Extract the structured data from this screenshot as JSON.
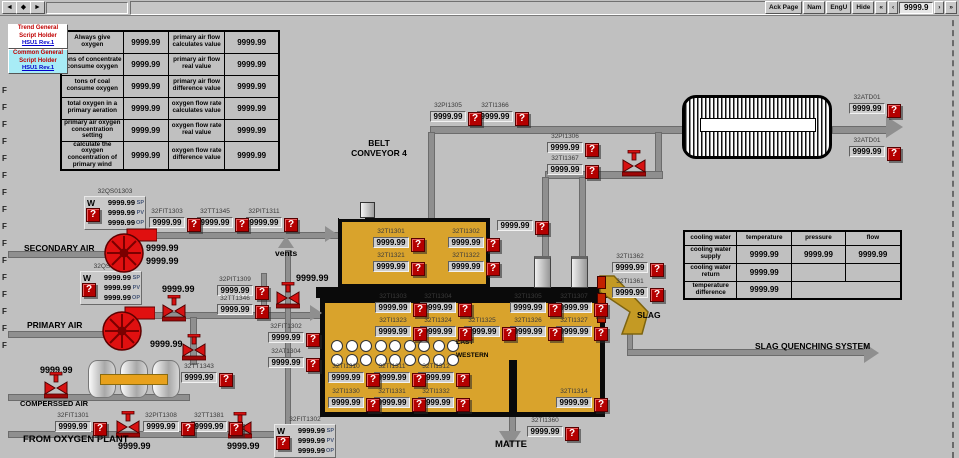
{
  "window": {
    "title": "PRIMARY OXYGEN-ENRICHED AIR OF FURNACE",
    "nav_buttons": [
      "◄",
      "◆",
      "►"
    ],
    "right_buttons": [
      "Ack Page",
      "Nam",
      "EngU",
      "Hide",
      "«",
      "‹"
    ],
    "right_buttons2": [
      "›",
      "»"
    ],
    "page_number": "9999.9"
  },
  "alarm_glyph": "?",
  "script_holders": [
    {
      "line1": "Trend General",
      "line2": "Script Holder",
      "version": "HSU1 Rev.1",
      "bg": "#ffffff"
    },
    {
      "line1": "Common General",
      "line2": "Script Holder",
      "version": "HSU1 Rev.1",
      "bg": "#a8ecf6"
    }
  ],
  "left_table": {
    "rows": [
      [
        "Always give oxygen",
        "9999.99",
        "primary air flow calculates value",
        "9999.99"
      ],
      [
        "tons of concentrate consume oxygen",
        "9999.99",
        "primary air flow real value",
        "9999.99"
      ],
      [
        "tons of coal consume oxygen",
        "9999.99",
        "primary air flow difference value",
        "9999.99"
      ],
      [
        "total oxygen in a primary aeration",
        "9999.99",
        "oxygen flow rate calculates value",
        "9999.99"
      ],
      [
        "primary air oxygen concentration setting",
        "9999.99",
        "oxygen flow rate real value",
        "9999.99"
      ],
      [
        "calculate the oxygen concentration of primary wind",
        "9999.99",
        "oxygen flow rate difference value",
        "9999.99"
      ]
    ]
  },
  "cooling_table": {
    "headers": [
      "cooling water",
      "temperature",
      "pressure",
      "flow"
    ],
    "rows": [
      [
        "cooling water supply",
        "9999.99",
        "9999.99",
        "9999.99"
      ],
      [
        "cooling water return",
        "9999.99",
        "",
        ""
      ],
      [
        "temperature difference",
        "9999.99",
        null,
        null
      ]
    ]
  },
  "equipment": {
    "waste_heat_boiler": "WASTE HEAT BOILER",
    "pressure_vessel": "PRESSURE VESSEL"
  },
  "furnace": {
    "tuyere_rows": 2,
    "tuyeres_per_row": 9
  },
  "labels": [
    {
      "text": "SECONDARY AIR",
      "x": 24,
      "y": 243,
      "fs": 8.5
    },
    {
      "text": "PRIMARY AIR",
      "x": 27,
      "y": 320,
      "fs": 8.5
    },
    {
      "text": "COMPERSSED AIR",
      "x": 20,
      "y": 399,
      "fs": 7.5
    },
    {
      "text": "FROM OXYGEN PLANT",
      "x": 23,
      "y": 434,
      "fs": 9.5
    },
    {
      "text": "vents",
      "x": 275,
      "y": 248,
      "fs": 8.5
    },
    {
      "text": "BELT\nCONVEYOR 4",
      "x": 336,
      "y": 138,
      "fs": 8.5,
      "w": 86
    },
    {
      "text": "MATTE",
      "x": 495,
      "y": 439,
      "fs": 9.5
    },
    {
      "text": "SLAG",
      "x": 637,
      "y": 310,
      "fs": 8.5
    },
    {
      "text": "SLAG QUENCHING SYSTEM",
      "x": 755,
      "y": 341,
      "fs": 8.5
    },
    {
      "text": "EAST",
      "x": 456,
      "y": 339,
      "fs": 6.5
    },
    {
      "text": "WESTERN",
      "x": 456,
      "y": 352,
      "fs": 6.5
    }
  ],
  "readouts": [
    {
      "tag": "32PI1305",
      "value": "9999.99",
      "x": 430,
      "y": 111
    },
    {
      "tag": "32TI1366",
      "value": "9999.99",
      "x": 477,
      "y": 111
    },
    {
      "tag": "32PI1306",
      "value": "9999.99",
      "x": 547,
      "y": 142
    },
    {
      "tag": "32TI1367",
      "value": "9999.99",
      "x": 547,
      "y": 164
    },
    {
      "tag": "32ATD01",
      "value": "9999.99",
      "x": 849,
      "y": 103
    },
    {
      "tag": "32ATD01",
      "value": "9999.99",
      "x": 849,
      "y": 146
    },
    {
      "tag": "32FIT1303",
      "value": "9999.99",
      "x": 149,
      "y": 217
    },
    {
      "tag": "32TT1345",
      "value": "9999.99",
      "x": 197,
      "y": 217
    },
    {
      "tag": "32PIT1311",
      "value": "9999.99",
      "x": 246,
      "y": 217
    },
    {
      "tag": "32PIT1309",
      "value": "9999.99",
      "x": 217,
      "y": 285
    },
    {
      "tag": "32TT1346",
      "value": "9999.99",
      "x": 217,
      "y": 304
    },
    {
      "tag": "32FIT1302",
      "value": "9999.99",
      "x": 268,
      "y": 332
    },
    {
      "tag": "32AT1304",
      "value": "9999.99",
      "x": 268,
      "y": 357
    },
    {
      "tag": "32FIT1301",
      "value": "9999.99",
      "x": 55,
      "y": 421
    },
    {
      "tag": "32PIT1308",
      "value": "9999.99",
      "x": 143,
      "y": 421
    },
    {
      "tag": "32TT1381",
      "value": "9999.99",
      "x": 191,
      "y": 421
    },
    {
      "tag": "32TT1343",
      "value": "9999.99",
      "x": 181,
      "y": 372
    },
    {
      "tag": "32TI1301",
      "value": "9999.99",
      "x": 373,
      "y": 237
    },
    {
      "tag": "32TI1302",
      "value": "9999.99",
      "x": 448,
      "y": 237
    },
    {
      "tag": "32TI1321",
      "value": "9999.99",
      "x": 373,
      "y": 261
    },
    {
      "tag": "32TI1322",
      "value": "9999.99",
      "x": 448,
      "y": 261
    },
    {
      "tag": "32TI1303",
      "value": "9999.99",
      "x": 375,
      "y": 302
    },
    {
      "tag": "32TI1304",
      "value": "9999.99",
      "x": 420,
      "y": 302
    },
    {
      "tag": "32TI1305",
      "value": "9999.99",
      "x": 510,
      "y": 302
    },
    {
      "tag": "32TI1307",
      "value": "9999.99",
      "x": 556,
      "y": 302
    },
    {
      "tag": "32TI1323",
      "value": "9999.99",
      "x": 375,
      "y": 326
    },
    {
      "tag": "32TI1324",
      "value": "9999.99",
      "x": 420,
      "y": 326
    },
    {
      "tag": "32TI1325",
      "value": "9999.99",
      "x": 464,
      "y": 326
    },
    {
      "tag": "32TI1326",
      "value": "9999.99",
      "x": 510,
      "y": 326
    },
    {
      "tag": "32TI1327",
      "value": "9999.99",
      "x": 556,
      "y": 326
    },
    {
      "tag": "32TI1310",
      "value": "9999.99",
      "x": 328,
      "y": 372
    },
    {
      "tag": "32TI1311",
      "value": "9999.99",
      "x": 374,
      "y": 372
    },
    {
      "tag": "32TI1312",
      "value": "9999.99",
      "x": 418,
      "y": 372
    },
    {
      "tag": "32TI1330",
      "value": "9999.99",
      "x": 328,
      "y": 397
    },
    {
      "tag": "32TI1331",
      "value": "9999.99",
      "x": 374,
      "y": 397
    },
    {
      "tag": "32TI1332",
      "value": "9999.99",
      "x": 418,
      "y": 397
    },
    {
      "tag": "32TI1314",
      "value": "9999.99",
      "x": 556,
      "y": 397
    },
    {
      "tag": "32TI1360",
      "value": "9999.99",
      "x": 527,
      "y": 426
    },
    {
      "tag": "32TI1362",
      "value": "9999.99",
      "x": 612,
      "y": 262
    },
    {
      "tag": "32TI1361",
      "value": "9999.99",
      "x": 612,
      "y": 287
    },
    {
      "tag": "",
      "value": "9999.99",
      "x": 497,
      "y": 220
    }
  ],
  "plain_values": [
    {
      "value": "9999.99",
      "x": 146,
      "y": 243
    },
    {
      "value": "9999.99",
      "x": 146,
      "y": 256
    },
    {
      "value": "9999.99",
      "x": 162,
      "y": 284
    },
    {
      "value": "9999.99",
      "x": 296,
      "y": 273
    },
    {
      "value": "9999.99",
      "x": 150,
      "y": 339
    },
    {
      "value": "9999.99",
      "x": 40,
      "y": 365
    },
    {
      "value": "9999.99",
      "x": 118,
      "y": 441
    },
    {
      "value": "9999.99",
      "x": 227,
      "y": 441
    }
  ],
  "faceplates": [
    {
      "tag": "32QS01303",
      "w": "W",
      "rows": [
        [
          "9999.99",
          "SP"
        ],
        [
          "9999.99",
          "PV"
        ],
        [
          "9999.99",
          "OP"
        ]
      ],
      "x": 84,
      "y": 196
    },
    {
      "tag": "32QS01302",
      "w": "W",
      "rows": [
        [
          "9999.99",
          "SP"
        ],
        [
          "9999.99",
          "PV"
        ],
        [
          "9999.99",
          "OP"
        ]
      ],
      "x": 80,
      "y": 271
    },
    {
      "tag": "32FIT1302",
      "w": "W",
      "rows": [
        [
          "9999.99",
          "SP"
        ],
        [
          "9999.99",
          "PV"
        ],
        [
          "9999.99",
          "OP"
        ]
      ],
      "x": 274,
      "y": 424
    }
  ],
  "f_markers": [
    "F",
    "F",
    "F",
    "F",
    "F",
    "F",
    "F",
    "F",
    "F",
    "F",
    "F",
    "F",
    "F",
    "F",
    "F",
    "F"
  ],
  "colors": {
    "furnace": "#d9a32c",
    "alarm": "#b40000",
    "pipe": "#8f8f8f",
    "slag": "#c49a24",
    "valve": "#d71212"
  }
}
